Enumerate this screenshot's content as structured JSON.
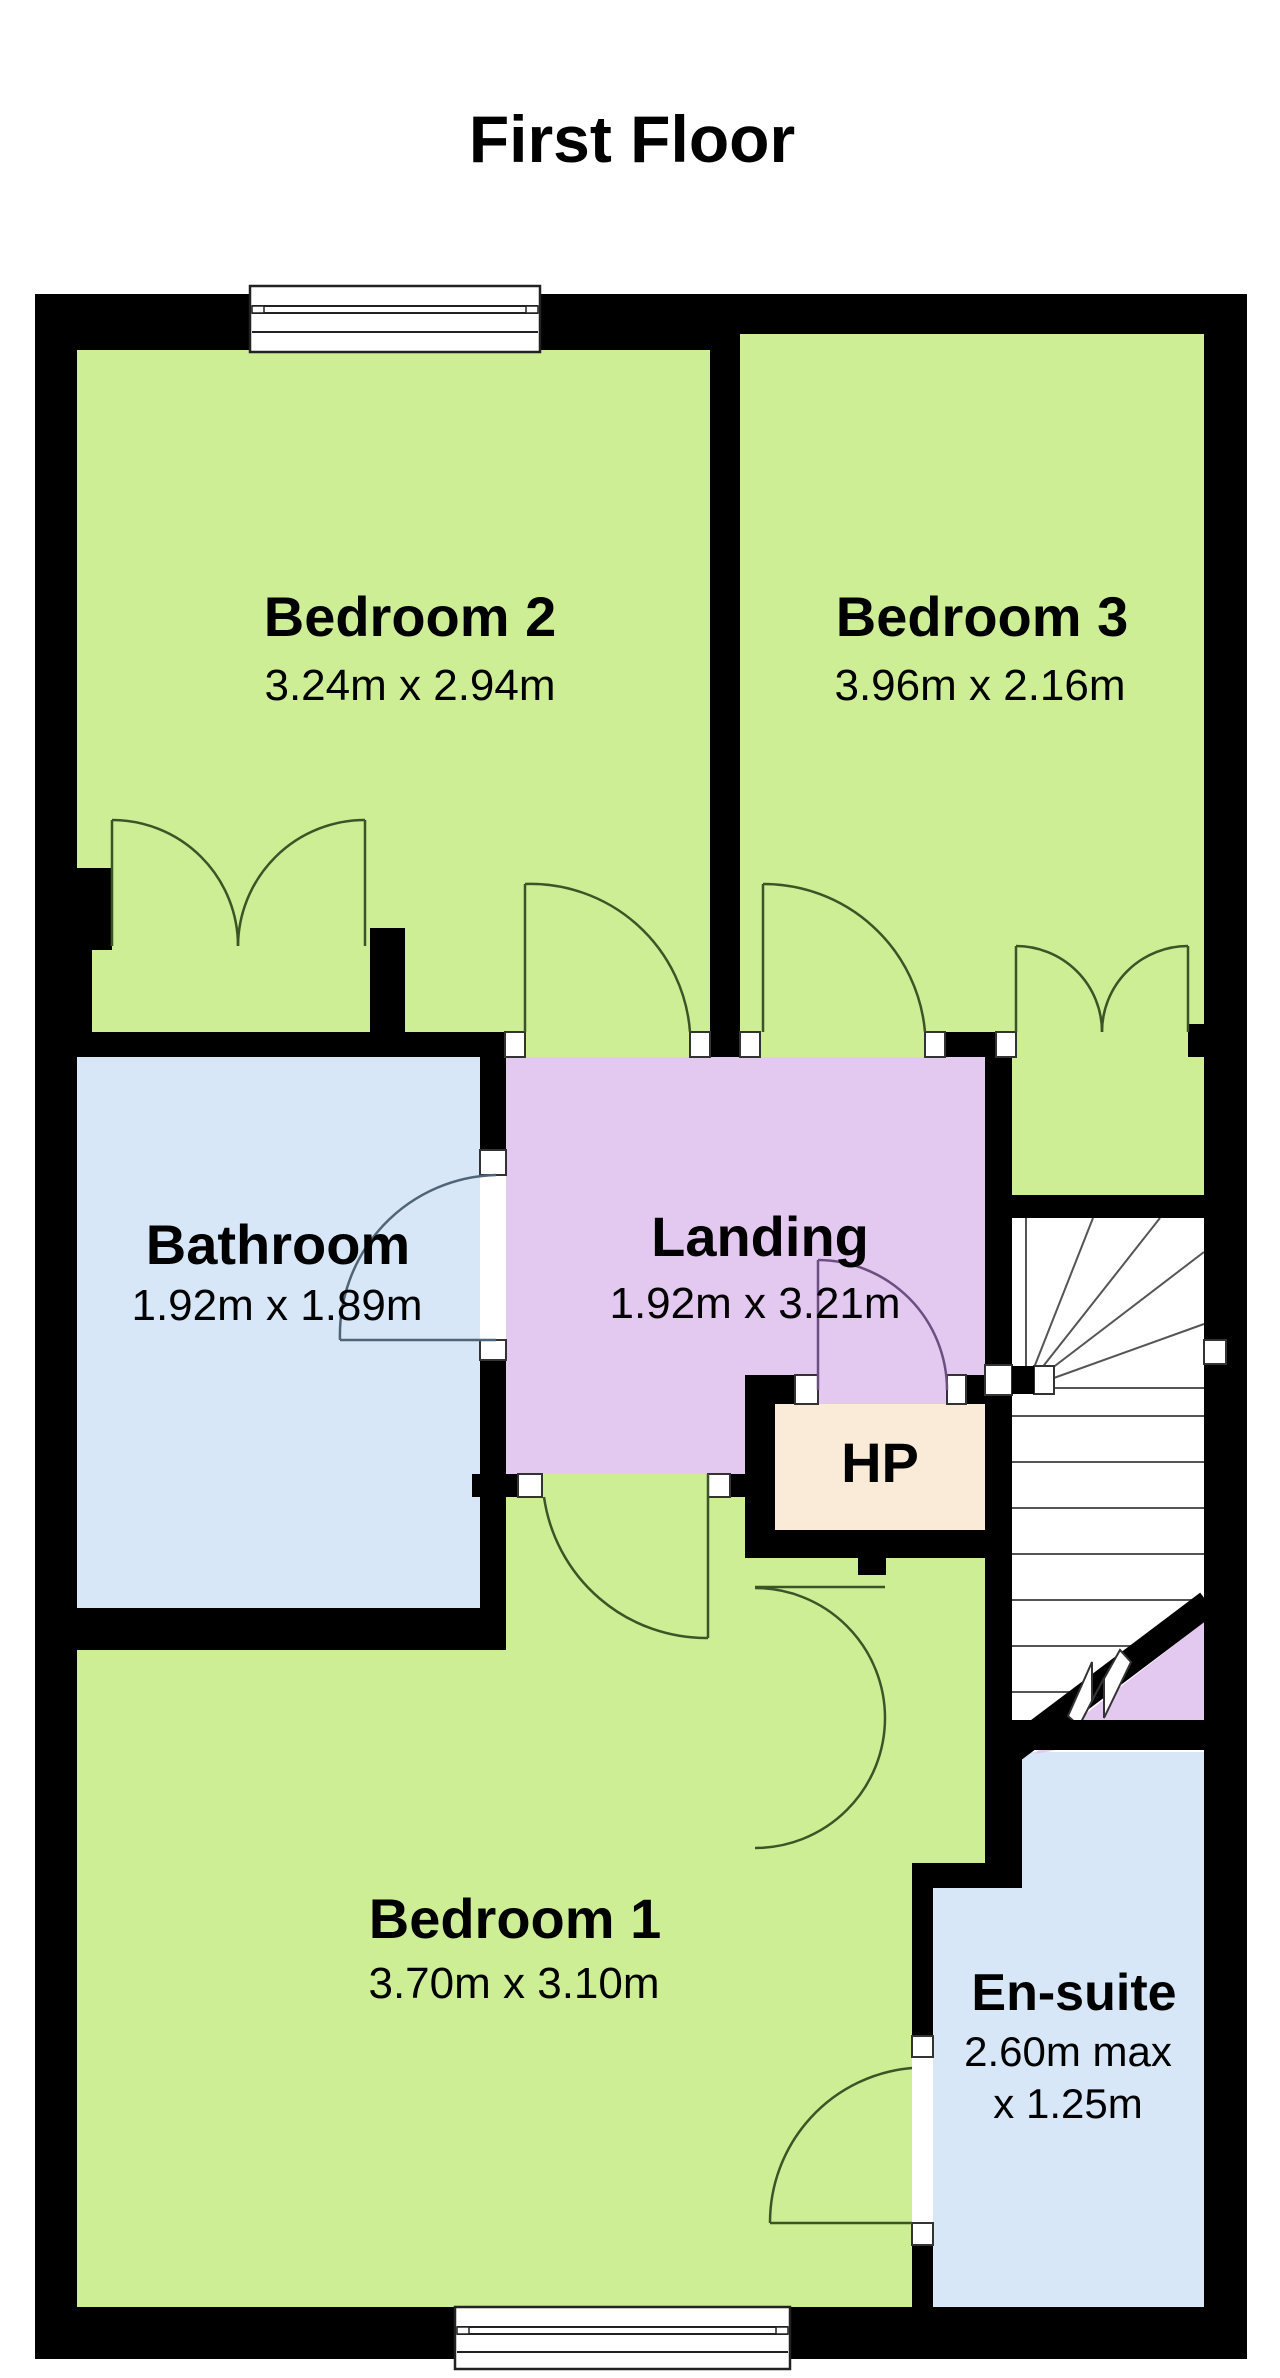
{
  "title": "First Floor",
  "rooms": {
    "bedroom2": {
      "name": "Bedroom 2",
      "dims": "3.24m x 2.94m"
    },
    "bedroom3": {
      "name": "Bedroom 3",
      "dims": "3.96m x 2.16m"
    },
    "bathroom": {
      "name": "Bathroom",
      "dims": "1.92m x 1.89m"
    },
    "landing": {
      "name": "Landing",
      "dims": "1.92m x 3.21m"
    },
    "hp": {
      "name": "HP"
    },
    "bedroom1": {
      "name": "Bedroom 1",
      "dims": "3.70m x 3.10m"
    },
    "ensuite": {
      "name": "En-suite",
      "dims_line1": "2.60m max",
      "dims_line2": "x 1.25m"
    }
  },
  "colors": {
    "wall": "#000000",
    "room_green": "#cdee95",
    "room_purple": "#e3c8f0",
    "room_blue": "#d7e7f7",
    "room_cream": "#faebd9",
    "stair_white": "#ffffff",
    "arc_green": "#3d5426",
    "arc_purple": "#6b4f80",
    "arc_blue": "#4f6577",
    "tread_line": "#555555",
    "window_frame": "#222222",
    "text": "#000000"
  }
}
